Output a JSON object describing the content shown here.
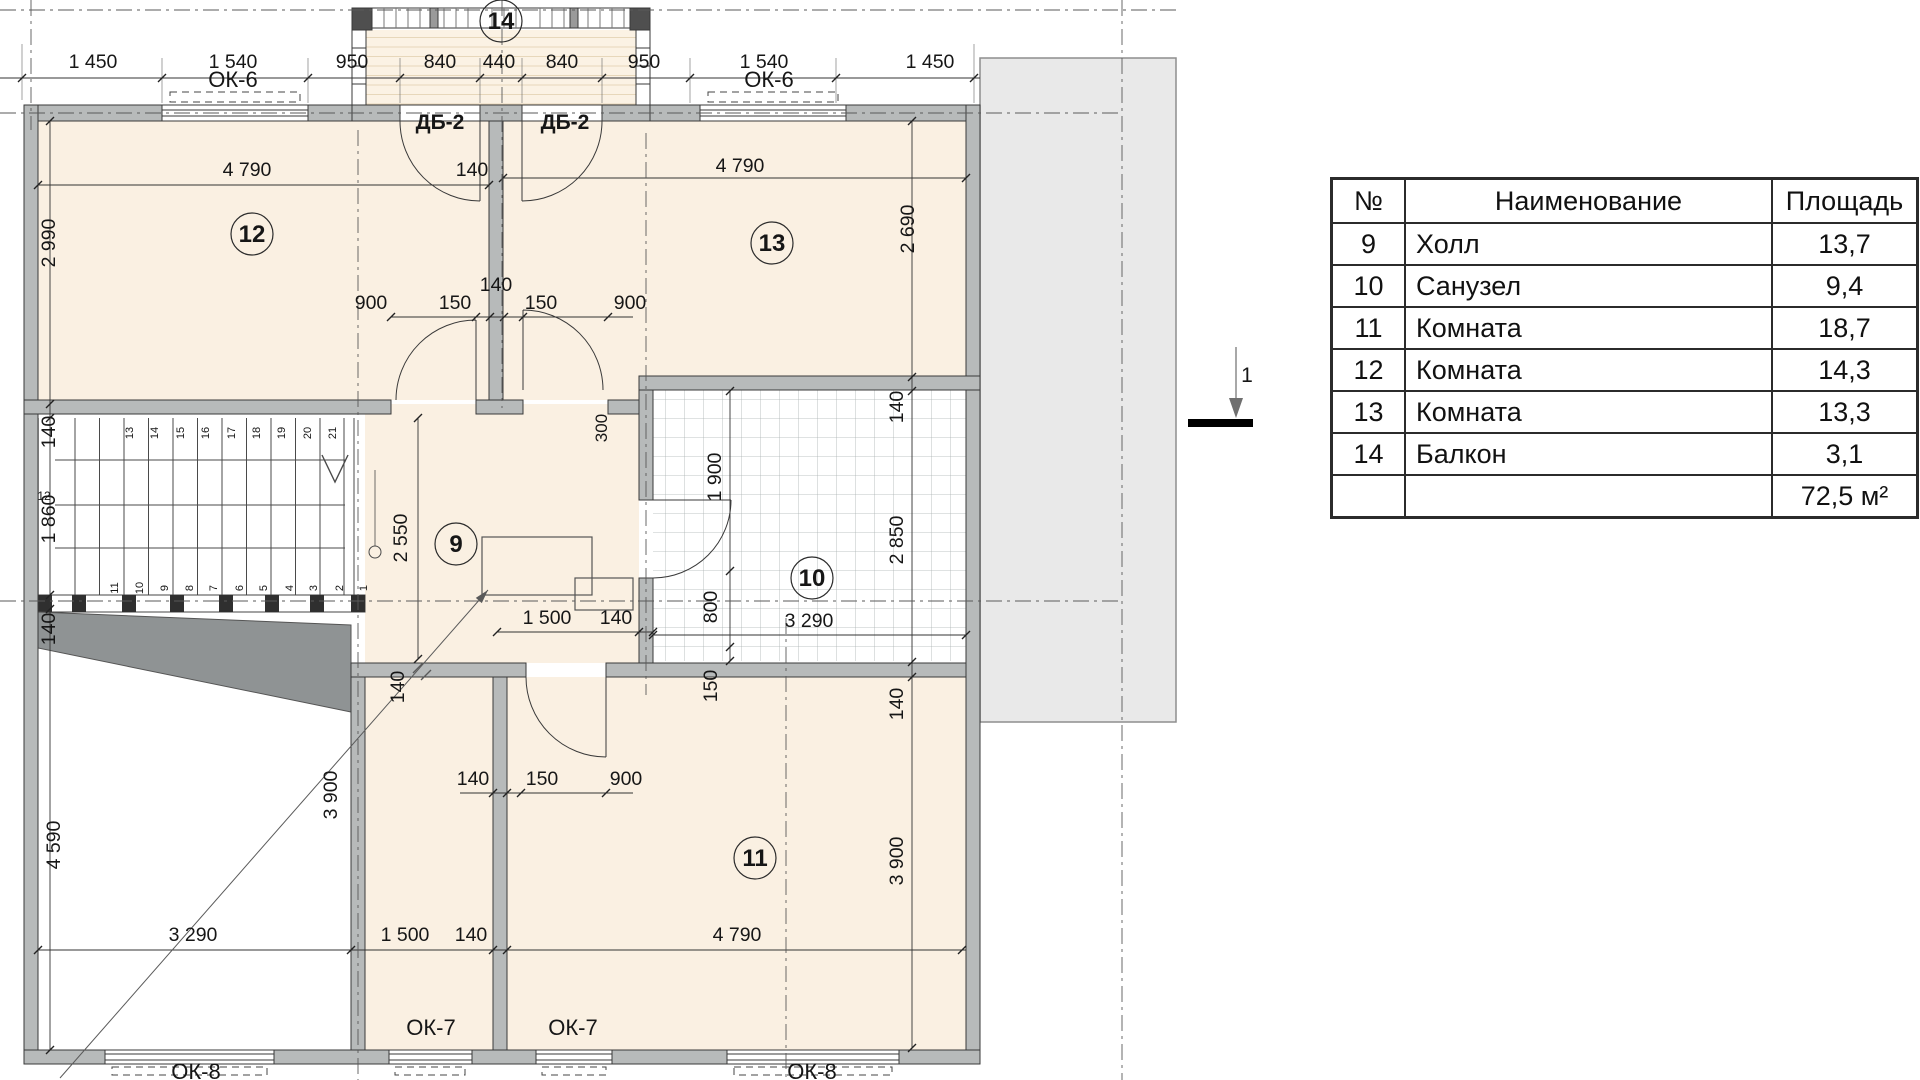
{
  "colors": {
    "cream": "#faf0e2",
    "wall": "#b7baba",
    "wall_dark": "#3a3a3a",
    "wedge": "#8f9394",
    "green": "#6e9c38",
    "ink": "#161616",
    "roof": "#e9e9e9",
    "grid": "#aab1b1"
  },
  "table": {
    "headers": [
      "№",
      "Наименование",
      "Площадь"
    ],
    "rows": [
      {
        "n": "9",
        "name": "Холл",
        "area": "13,7"
      },
      {
        "n": "10",
        "name": "Санузел",
        "area": "9,4"
      },
      {
        "n": "11",
        "name": "Комната",
        "area": "18,7"
      },
      {
        "n": "12",
        "name": "Комната",
        "area": "14,3"
      },
      {
        "n": "13",
        "name": "Комната",
        "area": "13,3"
      },
      {
        "n": "14",
        "name": "Балкон",
        "area": "3,1"
      }
    ],
    "total": {
      "n": "",
      "name": "",
      "area": "72,5 м²"
    }
  },
  "section_marker": {
    "label": "1"
  },
  "room_markers": [
    {
      "n": "12",
      "x": 252,
      "y": 234
    },
    {
      "n": "13",
      "x": 772,
      "y": 243
    },
    {
      "n": "9",
      "x": 456,
      "y": 544
    },
    {
      "n": "10",
      "x": 812,
      "y": 578
    },
    {
      "n": "11",
      "x": 755,
      "y": 858
    },
    {
      "n": "14",
      "x": 501,
      "y": 21
    }
  ],
  "labels": [
    {
      "t": "1 450",
      "x": 93,
      "y": 68
    },
    {
      "t": "1 540",
      "x": 233,
      "y": 68
    },
    {
      "t": "950",
      "x": 352,
      "y": 68
    },
    {
      "t": "840",
      "x": 440,
      "y": 68
    },
    {
      "t": "440",
      "x": 499,
      "y": 68
    },
    {
      "t": "840",
      "x": 562,
      "y": 68
    },
    {
      "t": "950",
      "x": 644,
      "y": 68
    },
    {
      "t": "1 540",
      "x": 764,
      "y": 68
    },
    {
      "t": "1 450",
      "x": 930,
      "y": 68
    },
    {
      "t": "4 790",
      "x": 247,
      "y": 176
    },
    {
      "t": "140",
      "x": 472,
      "y": 176
    },
    {
      "t": "4 790",
      "x": 740,
      "y": 172
    },
    {
      "t": "900",
      "x": 371,
      "y": 309
    },
    {
      "t": "150",
      "x": 455,
      "y": 309
    },
    {
      "t": "150",
      "x": 541,
      "y": 309
    },
    {
      "t": "900",
      "x": 630,
      "y": 309
    },
    {
      "t": "140",
      "x": 496,
      "y": 291
    },
    {
      "t": "1 500",
      "x": 547,
      "y": 624
    },
    {
      "t": "140",
      "x": 616,
      "y": 624
    },
    {
      "t": "3 290",
      "x": 809,
      "y": 627
    },
    {
      "t": "140",
      "x": 473,
      "y": 785
    },
    {
      "t": "150",
      "x": 542,
      "y": 785
    },
    {
      "t": "900",
      "x": 626,
      "y": 785
    },
    {
      "t": "3 290",
      "x": 193,
      "y": 941
    },
    {
      "t": "1 500",
      "x": 405,
      "y": 941
    },
    {
      "t": "140",
      "x": 471,
      "y": 941
    },
    {
      "t": "4 790",
      "x": 737,
      "y": 941
    },
    {
      "t": "2 990",
      "x": 55,
      "y": 243,
      "r": 1
    },
    {
      "t": "140",
      "x": 55,
      "y": 432,
      "r": 1
    },
    {
      "t": "1 860",
      "x": 55,
      "y": 519,
      "r": 1
    },
    {
      "t": "140",
      "x": 55,
      "y": 629,
      "r": 1
    },
    {
      "t": "4 590",
      "x": 60,
      "y": 845,
      "r": 1
    },
    {
      "t": "2 690",
      "x": 914,
      "y": 229,
      "r": 1
    },
    {
      "t": "140",
      "x": 903,
      "y": 407,
      "r": 1
    },
    {
      "t": "2 850",
      "x": 903,
      "y": 540,
      "r": 1
    },
    {
      "t": "140",
      "x": 903,
      "y": 704,
      "r": 1
    },
    {
      "t": "3 900",
      "x": 903,
      "y": 861,
      "r": 1
    },
    {
      "t": "3 900",
      "x": 337,
      "y": 795,
      "r": 1
    },
    {
      "t": "1 900",
      "x": 721,
      "y": 477,
      "r": 1
    },
    {
      "t": "800",
      "x": 717,
      "y": 607,
      "r": 1
    },
    {
      "t": "150",
      "x": 717,
      "y": 686,
      "r": 1
    },
    {
      "t": "2 550",
      "x": 407,
      "y": 538,
      "r": 1
    },
    {
      "t": "300",
      "x": 607,
      "y": 428,
      "r": 1,
      "s": 17
    },
    {
      "t": "140",
      "x": 404,
      "y": 687,
      "r": 1
    },
    {
      "t": "ОК-6",
      "x": 233,
      "y": 87,
      "s": 22,
      "c": "green"
    },
    {
      "t": "ОК-6",
      "x": 769,
      "y": 87,
      "s": 22,
      "c": "green"
    },
    {
      "t": "ОК-7",
      "x": 431,
      "y": 1035,
      "s": 22,
      "c": "green"
    },
    {
      "t": "ОК-7",
      "x": 573,
      "y": 1035,
      "s": 22,
      "c": "green"
    },
    {
      "t": "ОК-8",
      "x": 196,
      "y": 1079,
      "s": 22,
      "c": "green"
    },
    {
      "t": "ОК-8",
      "x": 812,
      "y": 1079,
      "s": 22,
      "c": "green"
    },
    {
      "t": "ДБ-2",
      "x": 440,
      "y": 129,
      "s": 21,
      "b": 1
    },
    {
      "t": "ДБ-2",
      "x": 565,
      "y": 129,
      "s": 21,
      "b": 1
    },
    {
      "t": "12",
      "x": 44,
      "y": 500,
      "s": 12
    },
    {
      "t": "13",
      "x": 133,
      "y": 433,
      "r": 1,
      "s": 11
    },
    {
      "t": "14",
      "x": 158,
      "y": 433,
      "r": 1,
      "s": 11
    },
    {
      "t": "15",
      "x": 184,
      "y": 433,
      "r": 1,
      "s": 11
    },
    {
      "t": "16",
      "x": 209,
      "y": 433,
      "r": 1,
      "s": 11
    },
    {
      "t": "17",
      "x": 235,
      "y": 433,
      "r": 1,
      "s": 11
    },
    {
      "t": "18",
      "x": 260,
      "y": 433,
      "r": 1,
      "s": 11
    },
    {
      "t": "19",
      "x": 285,
      "y": 433,
      "r": 1,
      "s": 11
    },
    {
      "t": "20",
      "x": 311,
      "y": 433,
      "r": 1,
      "s": 11
    },
    {
      "t": "21",
      "x": 336,
      "y": 433,
      "r": 1,
      "s": 11
    },
    {
      "t": "11",
      "x": 118,
      "y": 588,
      "r": 1,
      "s": 11
    },
    {
      "t": "10",
      "x": 143,
      "y": 588,
      "r": 1,
      "s": 11
    },
    {
      "t": "9",
      "x": 168,
      "y": 588,
      "r": 1,
      "s": 11
    },
    {
      "t": "8",
      "x": 193,
      "y": 588,
      "r": 1,
      "s": 11
    },
    {
      "t": "7",
      "x": 217,
      "y": 588,
      "r": 1,
      "s": 11
    },
    {
      "t": "6",
      "x": 243,
      "y": 588,
      "r": 1,
      "s": 11
    },
    {
      "t": "5",
      "x": 267,
      "y": 588,
      "r": 1,
      "s": 11
    },
    {
      "t": "4",
      "x": 293,
      "y": 588,
      "r": 1,
      "s": 11
    },
    {
      "t": "3",
      "x": 317,
      "y": 588,
      "r": 1,
      "s": 11
    },
    {
      "t": "2",
      "x": 343,
      "y": 588,
      "r": 1,
      "s": 11
    },
    {
      "t": "1",
      "x": 367,
      "y": 588,
      "r": 1,
      "s": 11
    },
    {
      "t": "1",
      "x": 1247,
      "y": 382,
      "s": 21
    }
  ]
}
